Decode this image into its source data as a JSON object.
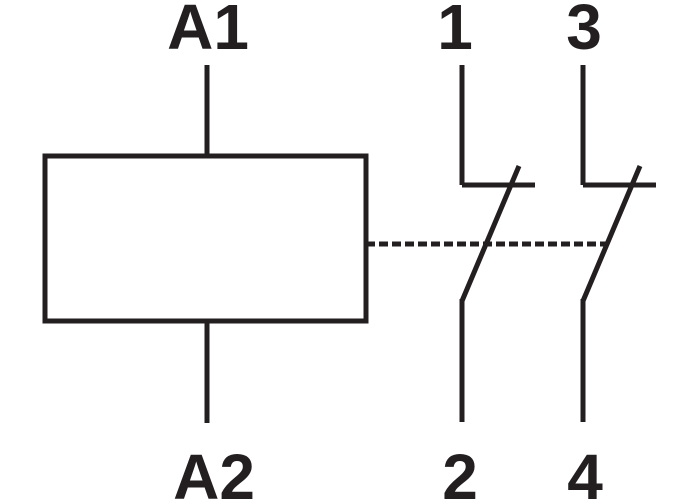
{
  "diagram": {
    "background": "#ffffff",
    "ink": "#231f20",
    "coil": {
      "top_terminal": "A1",
      "bottom_terminal": "A2"
    },
    "contacts": [
      {
        "top_terminal": "1",
        "bottom_terminal": "2"
      },
      {
        "top_terminal": "3",
        "bottom_terminal": "4"
      }
    ]
  }
}
